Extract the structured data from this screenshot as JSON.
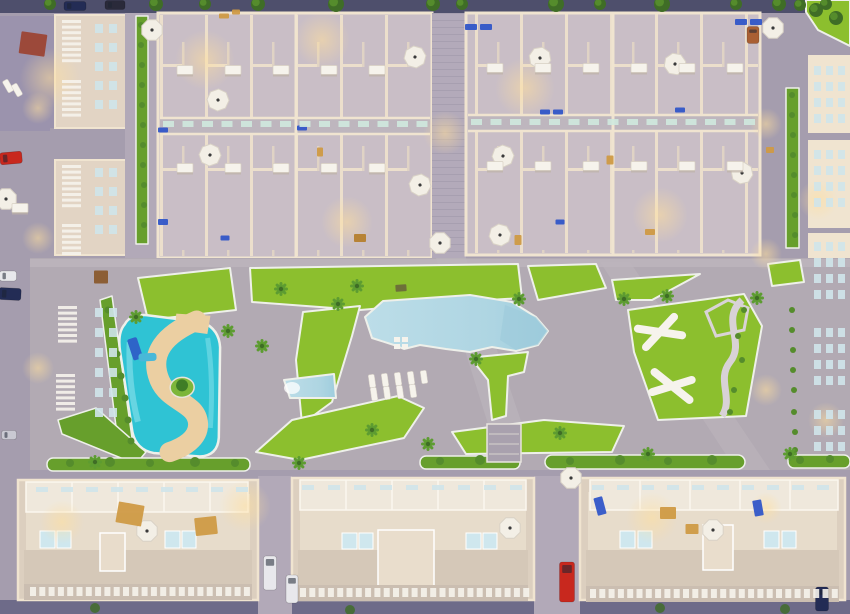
{
  "meta": {
    "description": "Aerial dusk 3D render of a residential masterplan: two large townhouse blocks at top, central amenity area with large pool, kids lazy-river pool and lawns, three apartment buildings with rooftop solariums at bottom, perimeter streets with parked cars",
    "width": 850,
    "height": 614
  },
  "palette": {
    "street": "#a59dae",
    "street_dark": "#4e4f6c",
    "street_bottom": "#6e6b89",
    "deck": "#b2aab3",
    "path": "#bdb5bd",
    "alley": "#b2a9b8",
    "lawn": "#8cbf2e",
    "hedge": "#679f2c",
    "curb": "#eef0ea",
    "tree_dark": "#3f6d26",
    "tree_light": "#558c2c",
    "palm": "#5d9c31",
    "pool_light": "#bcdde8",
    "pool_deep": "#9ecddd",
    "river": "#2fc3d4",
    "river_light": "#7fdde8",
    "sand": "#ebcfa2",
    "wall": "#e2d4c4",
    "wall_light": "#f0e4d0",
    "block_floor": "#c9bec6",
    "roof_blue": "#9b93ad",
    "bb_fill": "#dccfbf",
    "bb_inner": "#e7dccb",
    "bb_units": "#efe8dc",
    "bb_terrace": "#d5c8b8",
    "plunge": "#cfe7ee",
    "white": "#f6f3ec",
    "glow": "#ffdf9e",
    "car_red": "#c8281e",
    "car_white": "#e8e8ec",
    "car_navy": "#232c55",
    "car_silver": "#c9c9d2",
    "car_dark": "#2a2a3a",
    "car_brown": "#a95f33",
    "pergola_red": "#9c4534",
    "brown": "#8a5a2e",
    "tan": "#cf9a44",
    "tan_dark": "#b57f2e",
    "furn_blue": "#3156c8",
    "sign_dark": "#6b6b3a",
    "planter": "#cfe9de",
    "window": "#cfe4ea",
    "umbrella": "#f3efe6",
    "slide_blue": "#2e64c8",
    "slide_cyan": "#49b8d8"
  },
  "scene": {
    "glows": [
      [
        50,
        78,
        30
      ],
      [
        205,
        60,
        30
      ],
      [
        322,
        40,
        28
      ],
      [
        525,
        88,
        30
      ],
      [
        347,
        222,
        26
      ],
      [
        660,
        215,
        28
      ],
      [
        445,
        133,
        22
      ],
      [
        245,
        506,
        26
      ],
      [
        652,
        518,
        26
      ],
      [
        62,
        522,
        22
      ],
      [
        38,
        108,
        16
      ],
      [
        38,
        238,
        16
      ],
      [
        38,
        368,
        16
      ],
      [
        766,
        124,
        16
      ],
      [
        766,
        254,
        16
      ],
      [
        766,
        390,
        16
      ],
      [
        766,
        508,
        16
      ],
      [
        818,
        200,
        20
      ],
      [
        826,
        420,
        18
      ]
    ],
    "trees_top": [
      [
        50,
        4,
        6
      ],
      [
        156,
        4,
        7
      ],
      [
        205,
        4,
        6
      ],
      [
        258,
        4,
        7
      ],
      [
        336,
        4,
        8
      ],
      [
        433,
        4,
        7
      ],
      [
        462,
        4,
        6
      ],
      [
        556,
        4,
        8
      ],
      [
        600,
        4,
        6
      ],
      [
        662,
        4,
        8
      ],
      [
        736,
        4,
        6
      ],
      [
        779,
        4,
        7
      ],
      [
        826,
        4,
        6
      ],
      [
        816,
        10,
        7
      ],
      [
        836,
        18,
        7
      ],
      [
        800,
        5,
        6
      ]
    ],
    "trees_bottom": [
      [
        95,
        608,
        5
      ],
      [
        350,
        610,
        5
      ],
      [
        660,
        608,
        5
      ],
      [
        785,
        609,
        5
      ]
    ],
    "shrubs": [
      [
        744,
        310,
        3
      ],
      [
        738,
        336,
        3
      ],
      [
        742,
        360,
        3
      ],
      [
        734,
        390,
        3
      ],
      [
        730,
        412,
        3
      ],
      [
        70,
        463,
        4
      ],
      [
        110,
        462,
        5
      ],
      [
        150,
        463,
        4
      ],
      [
        195,
        462,
        5
      ],
      [
        235,
        463,
        4
      ],
      [
        440,
        461,
        4
      ],
      [
        480,
        460,
        5
      ],
      [
        570,
        461,
        4
      ],
      [
        620,
        460,
        5
      ],
      [
        668,
        461,
        4
      ],
      [
        712,
        460,
        5
      ],
      [
        800,
        460,
        4
      ],
      [
        830,
        459,
        4
      ],
      [
        108,
        310,
        3.5
      ],
      [
        113,
        332,
        3.5
      ],
      [
        117,
        354,
        3.5
      ],
      [
        121,
        376,
        3.5
      ],
      [
        125,
        398,
        3.5
      ],
      [
        128,
        420,
        3.5
      ],
      [
        131,
        441,
        3.5
      ],
      [
        792,
        95,
        3
      ],
      [
        792,
        115,
        3
      ],
      [
        793,
        135,
        3
      ],
      [
        793,
        155,
        3
      ],
      [
        794,
        175,
        3
      ],
      [
        794,
        195,
        3
      ],
      [
        795,
        215,
        3
      ],
      [
        795,
        235,
        3
      ],
      [
        792,
        310,
        3
      ],
      [
        792,
        330,
        3
      ],
      [
        793,
        350,
        3
      ],
      [
        793,
        370,
        3
      ],
      [
        794,
        390,
        3
      ],
      [
        794,
        412,
        3
      ],
      [
        795,
        432,
        3
      ],
      [
        795,
        450,
        3
      ],
      [
        141,
        25,
        3
      ],
      [
        141,
        45,
        3
      ],
      [
        142,
        65,
        3
      ],
      [
        142,
        85,
        3
      ],
      [
        142,
        105,
        3
      ],
      [
        143,
        125,
        3
      ],
      [
        143,
        145,
        3
      ],
      [
        143,
        165,
        3
      ],
      [
        144,
        185,
        3
      ],
      [
        144,
        205,
        3
      ],
      [
        144,
        225,
        3
      ]
    ],
    "palms": [
      [
        281,
        289
      ],
      [
        357,
        286
      ],
      [
        262,
        346
      ],
      [
        338,
        304
      ],
      [
        372,
        430
      ],
      [
        428,
        444
      ],
      [
        476,
        359
      ],
      [
        519,
        299
      ],
      [
        560,
        433
      ],
      [
        624,
        299
      ],
      [
        667,
        296
      ],
      [
        757,
        298
      ],
      [
        136,
        317
      ],
      [
        228,
        331
      ],
      [
        648,
        454
      ],
      [
        790,
        454
      ],
      [
        95,
        462
      ],
      [
        299,
        463
      ]
    ],
    "umbrellas": [
      [
        415,
        57,
        15
      ],
      [
        540,
        58,
        -10
      ],
      [
        503,
        156,
        20
      ],
      [
        420,
        185,
        -15
      ],
      [
        440,
        243,
        0
      ],
      [
        210,
        155,
        25
      ],
      [
        218,
        100,
        -20
      ],
      [
        675,
        64,
        10
      ],
      [
        742,
        173,
        -12
      ],
      [
        773,
        28,
        0
      ],
      [
        500,
        235,
        15
      ],
      [
        152,
        30,
        0
      ],
      [
        6,
        199,
        0
      ],
      [
        510,
        528,
        0
      ],
      [
        571,
        478,
        0
      ],
      [
        147,
        531,
        0
      ],
      [
        713,
        530,
        0
      ]
    ],
    "sunbeds": [
      [
        372,
        381,
        -8
      ],
      [
        385,
        380,
        -8
      ],
      [
        398,
        379,
        -8
      ],
      [
        411,
        378,
        -8
      ],
      [
        424,
        377,
        -8
      ],
      [
        374,
        394,
        -8
      ],
      [
        387,
        393,
        -8
      ],
      [
        400,
        392,
        -8
      ],
      [
        413,
        391,
        -8
      ],
      [
        8,
        86,
        -30
      ],
      [
        17,
        90,
        -30
      ]
    ],
    "tables": [
      [
        185,
        70
      ],
      [
        233,
        70
      ],
      [
        281,
        70
      ],
      [
        329,
        70
      ],
      [
        377,
        70
      ],
      [
        185,
        168
      ],
      [
        233,
        168
      ],
      [
        281,
        168
      ],
      [
        329,
        168
      ],
      [
        377,
        168
      ],
      [
        495,
        68
      ],
      [
        543,
        68
      ],
      [
        591,
        68
      ],
      [
        639,
        68
      ],
      [
        687,
        68
      ],
      [
        735,
        68
      ],
      [
        495,
        166
      ],
      [
        543,
        166
      ],
      [
        591,
        166
      ],
      [
        639,
        166
      ],
      [
        687,
        166
      ],
      [
        735,
        166
      ],
      [
        20,
        208
      ]
    ],
    "cars": [
      [
        11,
        158,
        22,
        12,
        "car_red",
        -5
      ],
      [
        8,
        276,
        17,
        10,
        "car_white",
        0
      ],
      [
        10,
        294,
        22,
        12,
        "car_navy",
        3
      ],
      [
        9,
        435,
        15,
        9,
        "car_silver",
        0
      ],
      [
        75,
        6,
        22,
        9,
        "car_navy",
        0
      ],
      [
        115,
        5,
        20,
        9,
        "car_dark",
        0
      ],
      [
        753,
        35,
        12,
        17,
        "car_brown",
        0
      ],
      [
        270,
        573,
        13,
        34,
        "car_white",
        0
      ],
      [
        292,
        589,
        12,
        28,
        "car_white",
        0
      ],
      [
        567,
        582,
        15,
        40,
        "car_red",
        0
      ],
      [
        822,
        599,
        13,
        24,
        "car_navy",
        0
      ]
    ],
    "specks": [
      [
        33,
        44,
        26,
        22,
        "pergola_red",
        8
      ],
      [
        101,
        277,
        14,
        13,
        "brown",
        0
      ],
      [
        130,
        514,
        26,
        21,
        "tan",
        10
      ],
      [
        206,
        526,
        22,
        18,
        "tan",
        -6
      ],
      [
        668,
        513,
        16,
        12,
        "tan",
        0
      ],
      [
        692,
        529,
        13,
        10,
        "tan",
        0
      ],
      [
        600,
        506,
        18,
        9,
        "furn_blue",
        75
      ],
      [
        758,
        508,
        16,
        9,
        "furn_blue",
        80
      ],
      [
        401,
        288,
        11,
        7,
        "sign_dark",
        -4
      ],
      [
        471,
        27,
        12,
        6,
        "furn_blue",
        0
      ],
      [
        486,
        27,
        12,
        6,
        "furn_blue",
        0
      ],
      [
        741,
        22,
        12,
        6,
        "furn_blue",
        0
      ],
      [
        756,
        22,
        12,
        6,
        "furn_blue",
        0
      ],
      [
        545,
        112,
        10,
        5,
        "furn_blue",
        0
      ],
      [
        558,
        112,
        10,
        5,
        "furn_blue",
        0
      ],
      [
        680,
        110,
        10,
        5,
        "furn_blue",
        0
      ],
      [
        163,
        130,
        10,
        5,
        "furn_blue",
        0
      ],
      [
        302,
        128,
        10,
        5,
        "furn_blue",
        0
      ],
      [
        163,
        222,
        10,
        6,
        "furn_blue",
        0
      ],
      [
        225,
        238,
        9,
        5,
        "furn_blue",
        0
      ],
      [
        560,
        222,
        9,
        5,
        "furn_blue",
        0
      ],
      [
        236,
        12,
        8,
        5,
        "tan",
        0
      ],
      [
        224,
        16,
        10,
        5,
        "tan",
        0
      ],
      [
        320,
        152,
        6,
        9,
        "tan",
        0
      ],
      [
        610,
        160,
        7,
        9,
        "tan",
        0
      ],
      [
        650,
        232,
        10,
        6,
        "tan",
        0
      ],
      [
        770,
        150,
        8,
        6,
        "tan",
        0
      ],
      [
        518,
        240,
        7,
        10,
        "tan",
        0
      ],
      [
        360,
        238,
        12,
        8,
        "tan_dark",
        0
      ]
    ],
    "grids": [
      {
        "x": 163,
        "y": 121,
        "cols": 14,
        "rows": 1,
        "cw": 11,
        "ch": 6,
        "gx": 19.5,
        "gy": 0,
        "color": "planter"
      },
      {
        "x": 471,
        "y": 119,
        "cols": 15,
        "rows": 1,
        "cw": 11,
        "ch": 6,
        "gx": 19.5,
        "gy": 0,
        "color": "planter"
      },
      {
        "x": 30,
        "y": 587,
        "cols": 24,
        "rows": 1,
        "cw": 6,
        "ch": 9,
        "gx": 9.3,
        "gy": 0,
        "color": "white"
      },
      {
        "x": 300,
        "y": 588,
        "cols": 25,
        "rows": 1,
        "cw": 6,
        "ch": 9,
        "gx": 9.3,
        "gy": 0,
        "color": "white"
      },
      {
        "x": 590,
        "y": 589,
        "cols": 27,
        "rows": 1,
        "cw": 6,
        "ch": 9,
        "gx": 9.3,
        "gy": 0,
        "color": "white"
      },
      {
        "x": 62,
        "y": 20,
        "cols": 1,
        "rows": 8,
        "cw": 19,
        "ch": 3,
        "gx": 0,
        "gy": 5.6,
        "color": "white"
      },
      {
        "x": 62,
        "y": 80,
        "cols": 1,
        "rows": 7,
        "cw": 19,
        "ch": 3,
        "gx": 0,
        "gy": 5.6,
        "color": "white"
      },
      {
        "x": 62,
        "y": 165,
        "cols": 1,
        "rows": 8,
        "cw": 19,
        "ch": 3,
        "gx": 0,
        "gy": 5.6,
        "color": "white"
      },
      {
        "x": 62,
        "y": 224,
        "cols": 1,
        "rows": 6,
        "cw": 19,
        "ch": 3,
        "gx": 0,
        "gy": 5.6,
        "color": "white"
      },
      {
        "x": 58,
        "y": 306,
        "cols": 1,
        "rows": 7,
        "cw": 19,
        "ch": 3,
        "gx": 0,
        "gy": 5.6,
        "color": "white"
      },
      {
        "x": 56,
        "y": 374,
        "cols": 1,
        "rows": 7,
        "cw": 19,
        "ch": 3,
        "gx": 0,
        "gy": 5.6,
        "color": "white"
      },
      {
        "x": 95,
        "y": 24,
        "cols": 2,
        "rows": 5,
        "cw": 8,
        "ch": 9,
        "gx": 14,
        "gy": 19,
        "color": "window"
      },
      {
        "x": 95,
        "y": 168,
        "cols": 2,
        "rows": 4,
        "cw": 8,
        "ch": 9,
        "gx": 14,
        "gy": 19,
        "color": "window"
      },
      {
        "x": 95,
        "y": 308,
        "cols": 2,
        "rows": 6,
        "cw": 8,
        "ch": 9,
        "gx": 14,
        "gy": 20,
        "color": "window"
      },
      {
        "x": 814,
        "y": 66,
        "cols": 3,
        "rows": 4,
        "cw": 7,
        "ch": 9,
        "gx": 12,
        "gy": 16,
        "color": "window"
      },
      {
        "x": 814,
        "y": 150,
        "cols": 3,
        "rows": 4,
        "cw": 7,
        "ch": 9,
        "gx": 12,
        "gy": 16,
        "color": "window"
      },
      {
        "x": 814,
        "y": 242,
        "cols": 3,
        "rows": 4,
        "cw": 7,
        "ch": 9,
        "gx": 12,
        "gy": 16,
        "color": "window"
      },
      {
        "x": 814,
        "y": 328,
        "cols": 3,
        "rows": 4,
        "cw": 7,
        "ch": 9,
        "gx": 12,
        "gy": 16,
        "color": "window"
      },
      {
        "x": 814,
        "y": 410,
        "cols": 3,
        "rows": 3,
        "cw": 7,
        "ch": 9,
        "gx": 12,
        "gy": 16,
        "color": "window"
      },
      {
        "x": 36,
        "y": 487,
        "cols": 9,
        "rows": 1,
        "cw": 12,
        "ch": 5,
        "gx": 25,
        "gy": 0,
        "color": "window"
      },
      {
        "x": 302,
        "y": 485,
        "cols": 9,
        "rows": 1,
        "cw": 12,
        "ch": 5,
        "gx": 26,
        "gy": 0,
        "color": "window"
      },
      {
        "x": 592,
        "y": 485,
        "cols": 10,
        "rows": 1,
        "cw": 12,
        "ch": 5,
        "gx": 25,
        "gy": 0,
        "color": "window"
      }
    ]
  }
}
